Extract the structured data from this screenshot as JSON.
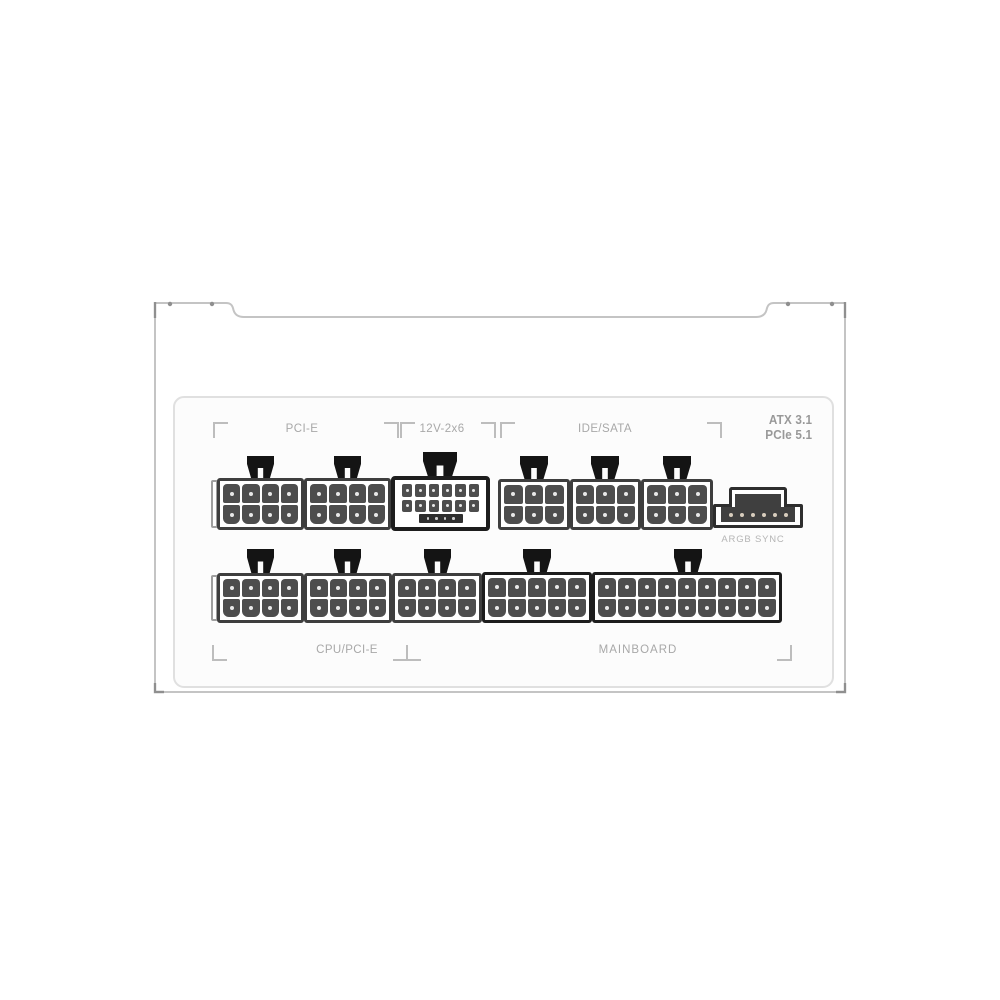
{
  "product": {
    "kind": "modular power supply connector panel",
    "finish": "white"
  },
  "labels": {
    "pcie": "PCI-E",
    "hpwr": "12V-2x6",
    "ide_sata": "IDE/SATA",
    "argb": "ARGB SYNC",
    "cpu_pcie": "CPU/PCI-E",
    "mainboard": "MAINBOARD",
    "badge_line1": "ATX 3.1",
    "badge_line2": "PCIe 5.1"
  },
  "connectors": {
    "pcie_1": {
      "type": "8-pin PCI-E socket",
      "rows": 2,
      "cols": 4
    },
    "pcie_2": {
      "type": "8-pin PCI-E socket",
      "rows": 2,
      "cols": 4
    },
    "hpwr": {
      "type": "16-pin 12V-2x6 socket",
      "rows": 2,
      "cols": 6,
      "sense_pins": 4
    },
    "ide_sata_1": {
      "type": "6-pin IDE/SATA socket",
      "rows": 2,
      "cols": 3
    },
    "ide_sata_2": {
      "type": "6-pin IDE/SATA socket",
      "rows": 2,
      "cols": 3
    },
    "ide_sata_3": {
      "type": "6-pin IDE/SATA socket",
      "rows": 2,
      "cols": 3
    },
    "argb_sync": {
      "type": "ARGB SYNC header",
      "pins": 6
    },
    "cpu_pcie_1": {
      "type": "8-pin CPU/PCI-E socket",
      "rows": 2,
      "cols": 4
    },
    "cpu_pcie_2": {
      "type": "8-pin CPU/PCI-E socket",
      "rows": 2,
      "cols": 4
    },
    "cpu_pcie_3": {
      "type": "8-pin CPU/PCI-E socket",
      "rows": 2,
      "cols": 4
    },
    "mainboard_1": {
      "type": "10-pin mainboard socket",
      "rows": 2,
      "cols": 5
    },
    "mainboard_2": {
      "type": "18-pin mainboard socket",
      "rows": 2,
      "cols": 9
    }
  },
  "colors": {
    "background": "#ffffff",
    "body-border": "#c4c4c4",
    "panel-bg": "#fcfcfc",
    "panel-border": "#e0e0e0",
    "connector-border": "#3e3e3e",
    "connector-border-dark": "#1d1d1d",
    "pin-fill": "#4d4d4d",
    "pin-dot": "#e8e8e8",
    "tab-fill": "#141414",
    "label-color": "#a8a8a8",
    "badge-color": "#999999",
    "argb-label-color": "#b5b5b5",
    "bracket-color": "#bdbdbd",
    "screw-color": "#8f8f8f"
  }
}
